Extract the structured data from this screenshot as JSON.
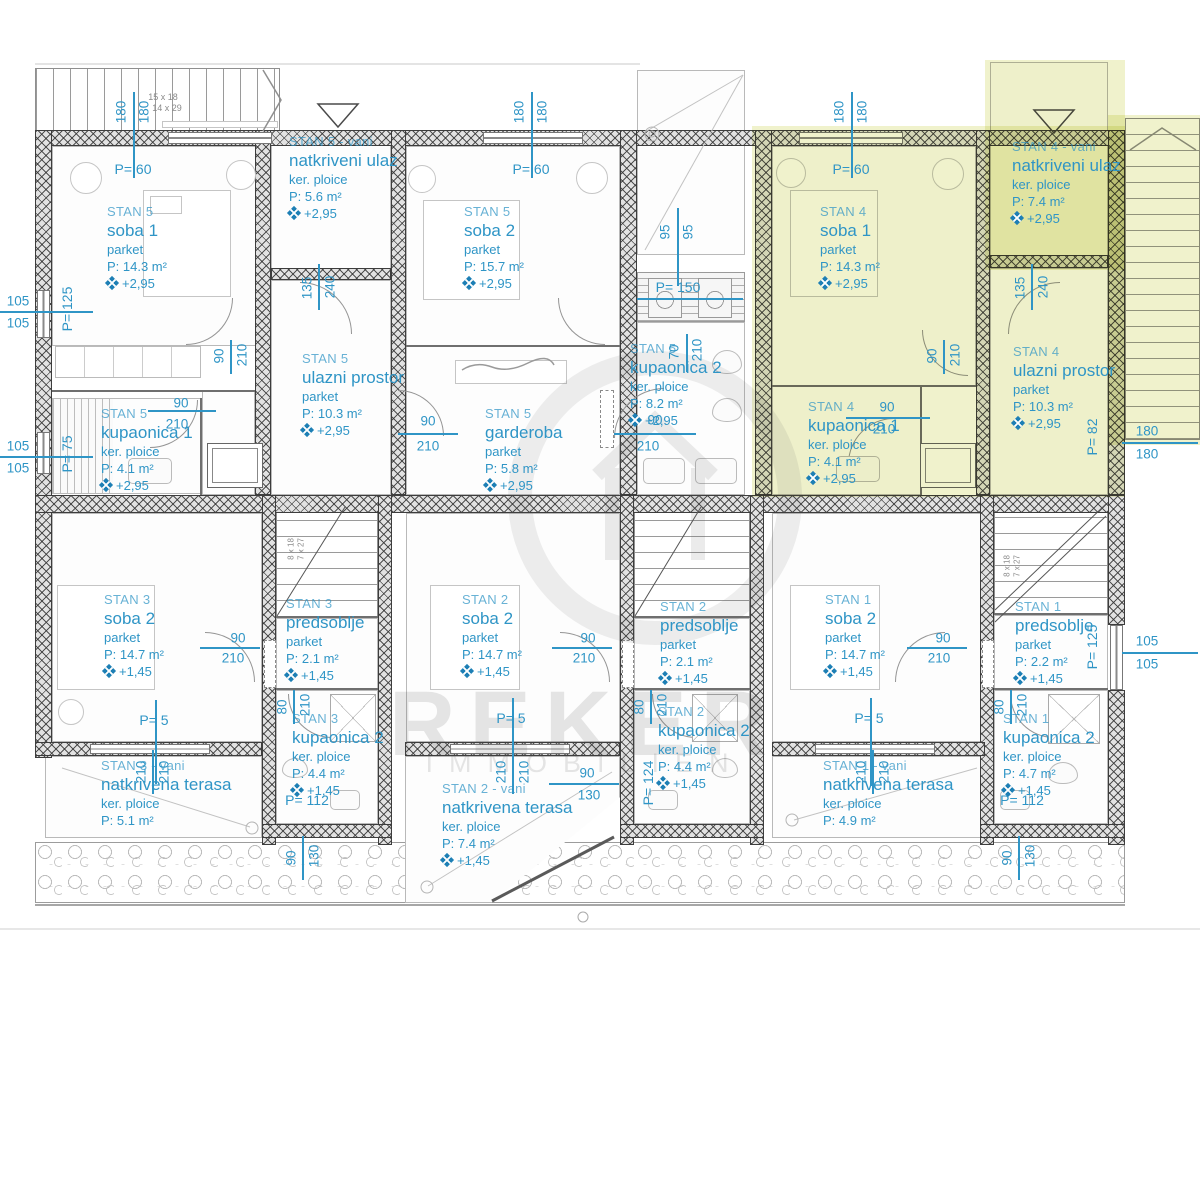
{
  "colors": {
    "accent": "#2f95c6",
    "highlight": "#eef0c3",
    "wall": "#3d3d3d"
  },
  "watermark": {
    "brand": "REKER",
    "brand_sub": "IMMOBILIEN"
  },
  "stair_specs": {
    "entry_stairs_1": "15 x 18",
    "entry_stairs_2": "14 x 29",
    "inner_stairs_1": "8 x 18",
    "inner_stairs_2": "7 x 27"
  },
  "dims": {
    "v70": "70",
    "v80": "80",
    "v90": "90",
    "v95": "95",
    "v105": "105",
    "v130": "130",
    "v135": "135",
    "v180": "180",
    "v210": "210",
    "v240": "240"
  },
  "plabels": {
    "p5": "P= 5",
    "p60": "P= 60",
    "p75": "P= 75",
    "p82": "P= 82",
    "p112": "P= 112",
    "p124": "P= 124",
    "p125": "P= 125",
    "p150": "P= 150"
  },
  "rooms": [
    {
      "unit": "STAN 5",
      "name": "soba 1",
      "floor": "parket",
      "area": "P: 14.3 m²",
      "level": "+2,95"
    },
    {
      "unit": "STAN 5 - vani",
      "name": "natkriveni ulaz",
      "floor": "ker. ploice",
      "area": "P: 5.6 m²",
      "level": "+2,95"
    },
    {
      "unit": "STAN 5",
      "name": "ulazni prostor",
      "floor": "parket",
      "area": "P: 10.3 m²",
      "level": "+2,95"
    },
    {
      "unit": "STAN 5",
      "name": "kupaonica 1",
      "floor": "ker. ploice",
      "area": "P: 4.1 m²",
      "level": "+2,95"
    },
    {
      "unit": "STAN 5",
      "name": "soba 2",
      "floor": "parket",
      "area": "P: 15.7 m²",
      "level": "+2,95"
    },
    {
      "unit": "STAN 5",
      "name": "garderoba",
      "floor": "parket",
      "area": "P: 5.8 m²",
      "level": "+2,95"
    },
    {
      "unit": "STAN 5",
      "name": "kupaonica 2",
      "floor": "ker. ploice",
      "area": "P: 8.2 m²",
      "level": "+2,95"
    },
    {
      "unit": "STAN 4",
      "name": "soba 1",
      "floor": "parket",
      "area": "P: 14.3 m²",
      "level": "+2,95"
    },
    {
      "unit": "STAN 4 - vani",
      "name": "natkriveni ulaz",
      "floor": "ker. ploice",
      "area": "P: 7.4 m²",
      "level": "+2,95"
    },
    {
      "unit": "STAN 4",
      "name": "ulazni prostor",
      "floor": "parket",
      "area": "P: 10.3 m²",
      "level": "+2,95"
    },
    {
      "unit": "STAN 4",
      "name": "kupaonica 1",
      "floor": "ker. ploice",
      "area": "P: 4.1 m²",
      "level": "+2,95"
    },
    {
      "unit": "STAN 3",
      "name": "soba 2",
      "floor": "parket",
      "area": "P: 14.7 m²",
      "level": "+1,45"
    },
    {
      "unit": "STAN 3",
      "name": "predsoblje",
      "floor": "parket",
      "area": "P: 2.1 m²",
      "level": "+1,45"
    },
    {
      "unit": "STAN 3",
      "name": "kupaonica 2",
      "floor": "ker. ploice",
      "area": "P: 4.4 m²",
      "level": "+1,45"
    },
    {
      "unit": "STAN 3 - vani",
      "name": "natkrivena terasa",
      "floor": "ker. ploice",
      "area": "P: 5.1 m²",
      "level": null
    },
    {
      "unit": "STAN 2",
      "name": "soba 2",
      "floor": "parket",
      "area": "P: 14.7 m²",
      "level": "+1,45"
    },
    {
      "unit": "STAN 2",
      "name": "predsoblje",
      "floor": "parket",
      "area": "P: 2.1 m²",
      "level": "+1,45"
    },
    {
      "unit": "STAN 2",
      "name": "kupaonica 2",
      "floor": "ker. ploice",
      "area": "P: 4.4 m²",
      "level": "+1,45"
    },
    {
      "unit": "STAN 2 - vani",
      "name": "natkrivena terasa",
      "floor": "ker. ploice",
      "area": "P: 7.4 m²",
      "level": "+1,45"
    },
    {
      "unit": "STAN 1",
      "name": "soba 2",
      "floor": "parket",
      "area": "P: 14.7 m²",
      "level": "+1,45"
    },
    {
      "unit": "STAN 1",
      "name": "predsoblje",
      "floor": "parket",
      "area": "P: 2.2 m²",
      "level": "+1,45"
    },
    {
      "unit": "STAN 1",
      "name": "kupaonica 2",
      "floor": "ker. ploice",
      "area": "P: 4.7 m²",
      "level": "+1,45"
    },
    {
      "unit": "STAN 1 - vani",
      "name": "natkrivena terasa",
      "floor": "ker. ploice",
      "area": "P: 4.9 m²",
      "level": null
    }
  ]
}
